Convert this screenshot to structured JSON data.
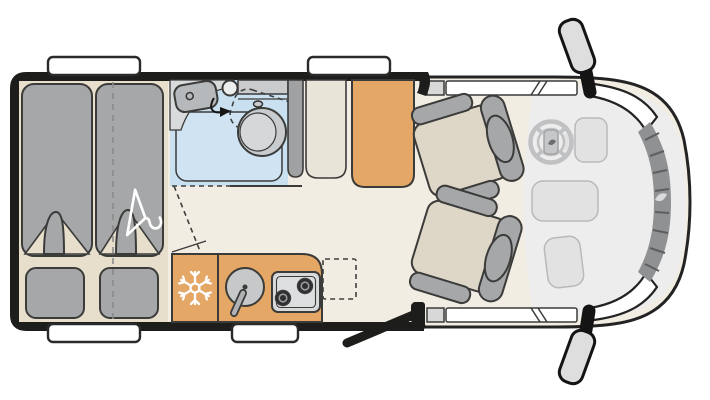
{
  "page": {
    "type": "motorhome-floorplan-top-view",
    "background": "#ffffff"
  },
  "colors": {
    "bg": "#ffffff",
    "wall": "#1d1d1b",
    "outline": "#3b3b3a",
    "floor": "#f2ede3",
    "bedbase": "#e7dfcc",
    "gray": "#a6a7a9",
    "blue": "#c9e0f1",
    "fixture": "#c9ccce",
    "counter": "#d9dadc",
    "orange": "#e4a765",
    "cushion": "#ded7c8",
    "cabgray": "#ededee",
    "dash": "#e2e2e3",
    "wheel": "#c0c1c3",
    "grille": "#8f9193",
    "white": "#ffffff"
  },
  "parts": {
    "vehicle": "Camper van floor plan, top view, cab on the right",
    "beds": "Rear twin single beds with pillows, folded duvet corners and clothes hanger",
    "bathroom": "Bathroom with washbasin, swivel toilet and shower tray",
    "wardrobe": "Tall cabinets and wardrobe beside bathroom",
    "kitchen": "Kitchen block with fridge (snowflake), round sink and two-burner hob",
    "table": "Fold-out worktop extension (dashed)",
    "entry_door": "Entrance door shown open",
    "cab": "Driver cab with two swivelled seats, steering wheel and dashboard",
    "mirrors": "Exterior wing mirrors",
    "windows": "Body windows"
  },
  "icons": {
    "fridge": "snowflake-icon",
    "bed_storage": "clothes-hanger-icon",
    "cockpit": "steering-wheel-icon"
  }
}
